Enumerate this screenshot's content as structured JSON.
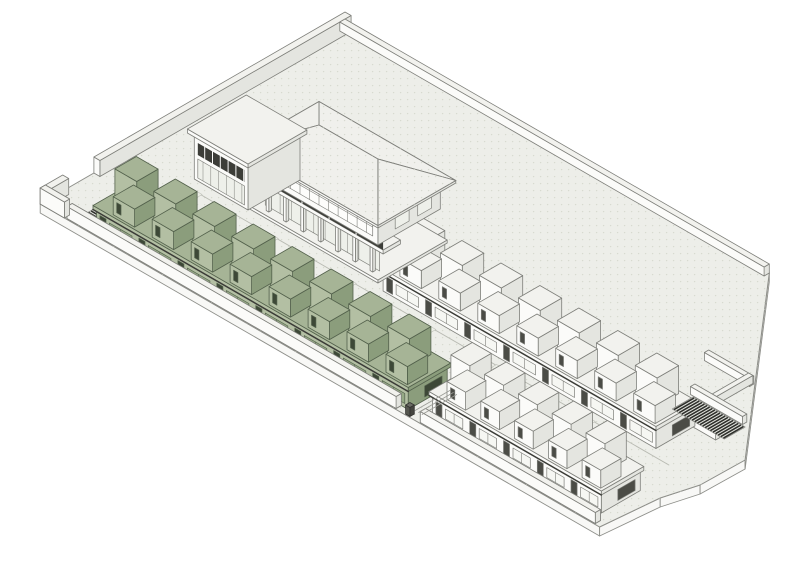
{
  "drawing": {
    "kind": "axonometric-site-massing-diagram",
    "highlighted_block": "west-townhouse-row"
  },
  "canvas": {
    "w": 800,
    "h": 562,
    "bg": "#ffffff"
  },
  "iso": {
    "ox": 345,
    "oy": 28,
    "cos": 0.866,
    "sin": 0.5
  },
  "colors": {
    "plate_top": "#edeee9",
    "plate_side": "#f8f8f6",
    "plate_dot": "#d7dad0",
    "outline": "#8e8f8a",
    "walk_line": "#b8bab2",
    "paver_fill": "#eceee7",
    "paver_line": "#c0c2ba",
    "roof": "#f0f0ec",
    "glass": "#eef0ea",
    "band_window": "#fdfdfb",
    "rail_dark": "#3c3d38",
    "hatch": "#2e2f2b",
    "hatch_bed": "#e2e4de",
    "step_line": "#9a9b95",
    "schemes": {
      "white": {
        "top": "#f2f2ee",
        "front": "#fbfbf9",
        "right": "#e4e5e0",
        "stroke": "#7e7f7a",
        "door": "#4b4c46",
        "win": "#f6f7f3"
      },
      "green": {
        "top": "#a6b496",
        "front": "#b3bfa3",
        "right": "#8b9d7c",
        "stroke": "#53614c",
        "door": "#3d4837",
        "win": "#95a985"
      },
      "dark": {
        "top": "#6a6b64",
        "front": "#55564f",
        "right": "#44453f",
        "stroke": "#323230",
        "door": "#323230",
        "win": "#55564f"
      }
    }
  },
  "plate": {
    "outline": [
      [
        0,
        0
      ],
      [
        0,
        52
      ],
      [
        -9,
        52
      ],
      [
        -9,
        66
      ],
      [
        0,
        66
      ],
      [
        0,
        352
      ],
      [
        646,
        352
      ],
      [
        652,
        288
      ],
      [
        662,
        252
      ],
      [
        663,
        201
      ],
      [
        490,
        0
      ]
    ],
    "thickness": 9,
    "side_edges": [
      [
        5,
        6
      ],
      [
        6,
        7
      ],
      [
        7,
        8
      ],
      [
        8,
        9
      ],
      [
        9,
        10
      ]
    ]
  },
  "walls": [
    {
      "name": "northwest-boundary-wall",
      "u": 0,
      "v": 0,
      "du": 7,
      "dv": 290,
      "h": 16
    },
    {
      "name": "west-gate-wall",
      "u": 0,
      "v": 326,
      "du": 7,
      "dv": 26,
      "h": 16
    },
    {
      "name": "west-corner-wall",
      "u": 0,
      "v": 346,
      "du": 28,
      "dv": 6,
      "h": 16
    },
    {
      "name": "northeast-curb-wall",
      "u": 0,
      "v": 0,
      "du": 490,
      "dv": 6,
      "h": 9
    },
    {
      "name": "southwest-front-wall",
      "u": 30,
      "v": 345,
      "du": 380,
      "dv": 6,
      "h": 12
    },
    {
      "name": "southeast-front-wall",
      "u": 438,
      "v": 345,
      "du": 202,
      "dv": 6,
      "h": 11
    },
    {
      "name": "east-court-wall-a",
      "u": 540,
      "v": 120,
      "du": 52,
      "dv": 5,
      "h": 8
    },
    {
      "name": "east-court-wall-b",
      "u": 586,
      "v": 120,
      "du": 5,
      "dv": 42,
      "h": 8
    },
    {
      "name": "east-ramp-wall-a",
      "u": 566,
      "v": 162,
      "du": 60,
      "dv": 5,
      "h": 8
    },
    {
      "name": "east-ramp-wall-b",
      "u": 566,
      "v": 193,
      "du": 60,
      "dv": 5,
      "h": 8
    }
  ],
  "walkway": {
    "u0": 60,
    "u1": 624,
    "lines_v": [
      250,
      296
    ]
  },
  "pavers": [
    {
      "u": 62,
      "v": 249,
      "du": 22,
      "dv": 46
    },
    {
      "u": 150,
      "v": 249,
      "du": 22,
      "dv": 46
    },
    {
      "u": 240,
      "v": 249,
      "du": 22,
      "dv": 46
    },
    {
      "u": 332,
      "v": 249,
      "du": 22,
      "dv": 46
    },
    {
      "u": 424,
      "v": 249,
      "du": 22,
      "dv": 46
    },
    {
      "u": 516,
      "v": 249,
      "du": 22,
      "dv": 46
    }
  ],
  "ramps": [
    {
      "name": "west-ramp",
      "u": 36,
      "v": 298,
      "du": 22,
      "dv": 52,
      "axis": "v",
      "step": 3
    },
    {
      "name": "east-ramp",
      "u": 570,
      "v": 168,
      "du": 60,
      "dv": 24,
      "axis": "u",
      "step": 3
    }
  ],
  "rows": [
    {
      "name": "east-townhouse-row",
      "scheme": "white",
      "u": 285,
      "v": 196,
      "len": 315,
      "depth": 45,
      "units": 7,
      "ground_h": 20,
      "slab_h": 4,
      "back_h": 28,
      "front_h": 18
    },
    {
      "name": "west-townhouse-row",
      "scheme": "green",
      "u": 58,
      "v": 300,
      "len": 360,
      "depth": 45,
      "units": 8,
      "ground_h": 20,
      "slab_h": 4,
      "back_h": 28,
      "front_h": 18
    },
    {
      "name": "south-townhouse-row",
      "scheme": "white",
      "u": 438,
      "v": 292,
      "len": 195,
      "depth": 45,
      "units": 5,
      "ground_h": 20,
      "slab_h": 4,
      "back_h": 28,
      "front_h": 18
    }
  ],
  "clubhouse": {
    "name": "clubhouse-building",
    "u": 130,
    "v": 160,
    "du": 140,
    "dv": 72,
    "plinth_h": 3,
    "col_top": 30,
    "cols": 7,
    "balcony_z": 30,
    "balcony_h": 4,
    "rail_z0": 34,
    "rail_z1": 42,
    "upper_z": 34,
    "upper_h": 28,
    "fascia_z": 60,
    "eave_z": 62.5,
    "ridge_z": 84,
    "eave_ext": 9,
    "ridge_inset": 36,
    "annex": {
      "u": 64,
      "v": 178,
      "du": 62,
      "dv": 60,
      "h": 46,
      "band_z0": 26,
      "band_z1": 38,
      "glass_z0": 3,
      "glass_z1": 22,
      "roof_z": 46,
      "roof_h": 4
    }
  },
  "bollard": {
    "u": 421,
    "v": 346,
    "du": 5,
    "dv": 5,
    "h": 9
  },
  "steps": {
    "u_list": [
      423,
      427,
      431
    ],
    "v0": 302,
    "v1": 342
  }
}
